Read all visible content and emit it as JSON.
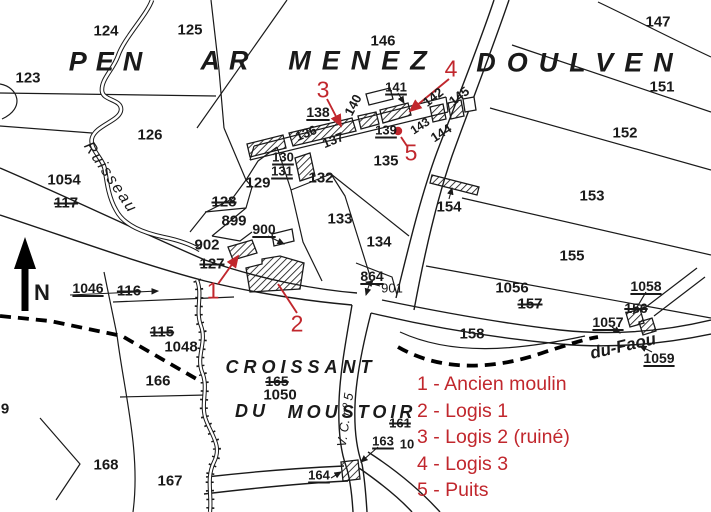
{
  "colors": {
    "annotation_red": "#c1272d",
    "ink": "#1a1a1a",
    "paper": "#ffffff"
  },
  "legend": {
    "items": [
      {
        "text": "1 - Ancien moulin"
      },
      {
        "text": "2 - Logis 1"
      },
      {
        "text": "3 - Logis 2 (ruiné)"
      },
      {
        "text": "4 - Logis 3"
      },
      {
        "text": "5 - Puits"
      }
    ]
  },
  "map": {
    "labels": [
      {
        "t": "PEN",
        "x": 110,
        "y": 62,
        "s": 27,
        "i": 1,
        "sp": 9
      },
      {
        "t": "AR",
        "x": 229,
        "y": 61,
        "s": 27,
        "i": 1,
        "sp": 9
      },
      {
        "t": "MENEZ",
        "x": 363,
        "y": 61,
        "s": 27,
        "i": 1,
        "sp": 11
      },
      {
        "t": "DOULVEN",
        "x": 580,
        "y": 63,
        "s": 27,
        "i": 1,
        "sp": 11
      },
      {
        "t": "123",
        "x": 28,
        "y": 78
      },
      {
        "t": "124",
        "x": 106,
        "y": 31
      },
      {
        "t": "125",
        "x": 190,
        "y": 30
      },
      {
        "t": "126",
        "x": 150,
        "y": 135
      },
      {
        "t": "146",
        "x": 383,
        "y": 41
      },
      {
        "t": "147",
        "x": 658,
        "y": 22
      },
      {
        "t": "151",
        "x": 662,
        "y": 87
      },
      {
        "t": "152",
        "x": 625,
        "y": 133
      },
      {
        "t": "153",
        "x": 592,
        "y": 196
      },
      {
        "t": "155",
        "x": 572,
        "y": 256
      },
      {
        "t": "Ruisseau",
        "x": 110,
        "y": 178,
        "s": 16,
        "r": 56,
        "i": 1,
        "b": 0,
        "sp": 2
      },
      {
        "t": "1054",
        "x": 64,
        "y": 180
      },
      {
        "t": "117",
        "x": 66,
        "y": 203,
        "st": "s"
      },
      {
        "t": "128",
        "x": 224,
        "y": 202,
        "st": "s"
      },
      {
        "t": "899",
        "x": 234,
        "y": 221
      },
      {
        "t": "902",
        "x": 207,
        "y": 245
      },
      {
        "t": "127",
        "x": 212,
        "y": 264,
        "st": "s"
      },
      {
        "t": "900",
        "x": 264,
        "y": 229,
        "st": "u",
        "s": 14
      },
      {
        "t": "129",
        "x": 258,
        "y": 183
      },
      {
        "t": "130",
        "x": 283,
        "y": 157,
        "st": "u",
        "s": 13
      },
      {
        "t": "131",
        "x": 282,
        "y": 171,
        "st": "u",
        "s": 13
      },
      {
        "t": "132",
        "x": 321,
        "y": 178
      },
      {
        "t": "133",
        "x": 340,
        "y": 219
      },
      {
        "t": "134",
        "x": 379,
        "y": 242
      },
      {
        "t": "135",
        "x": 386,
        "y": 161
      },
      {
        "t": "136",
        "x": 306,
        "y": 133,
        "r": -22,
        "s": 13
      },
      {
        "t": "137",
        "x": 333,
        "y": 140,
        "r": -22,
        "s": 13
      },
      {
        "t": "138",
        "x": 318,
        "y": 112,
        "st": "u",
        "s": 14
      },
      {
        "t": "140",
        "x": 353,
        "y": 105,
        "r": -62,
        "s": 13
      },
      {
        "t": "141",
        "x": 396,
        "y": 87,
        "st": "u",
        "s": 13
      },
      {
        "t": "139",
        "x": 386,
        "y": 130,
        "st": "u",
        "s": 13
      },
      {
        "t": "142",
        "x": 433,
        "y": 97,
        "r": -38,
        "s": 13
      },
      {
        "t": "145",
        "x": 459,
        "y": 96,
        "r": -38,
        "s": 13
      },
      {
        "t": "143",
        "x": 420,
        "y": 126,
        "r": -33,
        "s": 12
      },
      {
        "t": "144",
        "x": 441,
        "y": 133,
        "r": -33,
        "s": 13
      },
      {
        "t": "154",
        "x": 449,
        "y": 207
      },
      {
        "t": "864",
        "x": 372,
        "y": 276,
        "st": "u",
        "s": 14
      },
      {
        "t": "901",
        "x": 392,
        "y": 288,
        "s": 13,
        "b": 0
      },
      {
        "t": "1056",
        "x": 512,
        "y": 288
      },
      {
        "t": "157",
        "x": 530,
        "y": 304,
        "st": "s"
      },
      {
        "t": "158",
        "x": 472,
        "y": 334
      },
      {
        "t": "1058",
        "x": 646,
        "y": 286,
        "st": "u",
        "s": 14
      },
      {
        "t": "156",
        "x": 636,
        "y": 308,
        "st": "s",
        "s": 14
      },
      {
        "t": "1057",
        "x": 608,
        "y": 322,
        "st": "u",
        "s": 14
      },
      {
        "t": "1059",
        "x": 659,
        "y": 358,
        "st": "u",
        "s": 14
      },
      {
        "t": "du-Faou",
        "x": 623,
        "y": 346,
        "s": 17,
        "r": -13,
        "i": 1
      },
      {
        "t": "1046",
        "x": 88,
        "y": 288,
        "st": "u",
        "s": 14
      },
      {
        "t": "116",
        "x": 129,
        "y": 291,
        "st": "s"
      },
      {
        "t": "115",
        "x": 162,
        "y": 332,
        "st": "s"
      },
      {
        "t": "1048",
        "x": 181,
        "y": 347
      },
      {
        "t": "166",
        "x": 158,
        "y": 381
      },
      {
        "t": "168",
        "x": 106,
        "y": 465
      },
      {
        "t": "167",
        "x": 170,
        "y": 481
      },
      {
        "t": "9",
        "x": 5,
        "y": 409
      },
      {
        "t": "CROISSANT",
        "x": 301,
        "y": 367,
        "s": 18,
        "i": 1,
        "sp": 5
      },
      {
        "t": "165",
        "x": 277,
        "y": 381,
        "st": "s",
        "s": 14
      },
      {
        "t": "1050",
        "x": 280,
        "y": 395
      },
      {
        "t": "DU",
        "x": 252,
        "y": 411,
        "s": 18,
        "i": 1,
        "sp": 4
      },
      {
        "t": "MOUSTOIR",
        "x": 352,
        "y": 412,
        "s": 18,
        "i": 1,
        "sp": 4
      },
      {
        "t": "161",
        "x": 400,
        "y": 423,
        "st": "s",
        "s": 13
      },
      {
        "t": "163",
        "x": 383,
        "y": 441,
        "st": "u",
        "s": 13
      },
      {
        "t": "10",
        "x": 407,
        "y": 444,
        "s": 13
      },
      {
        "t": "164",
        "x": 319,
        "y": 475,
        "st": "u",
        "s": 13
      },
      {
        "t": "V. C. nº 5",
        "x": 345,
        "y": 420,
        "s": 13,
        "r": -82,
        "i": 1,
        "b": 0
      },
      {
        "t": "N",
        "x": 42,
        "y": 293,
        "s": 22
      },
      {
        "t": "1",
        "x": 213,
        "y": 291,
        "s": 23,
        "c": "r"
      },
      {
        "t": "2",
        "x": 297,
        "y": 324,
        "s": 23,
        "c": "r"
      },
      {
        "t": "3",
        "x": 323,
        "y": 90,
        "s": 23,
        "c": "r"
      },
      {
        "t": "4",
        "x": 451,
        "y": 69,
        "s": 23,
        "c": "r"
      },
      {
        "t": "5",
        "x": 411,
        "y": 153,
        "s": 23,
        "c": "r"
      }
    ]
  }
}
